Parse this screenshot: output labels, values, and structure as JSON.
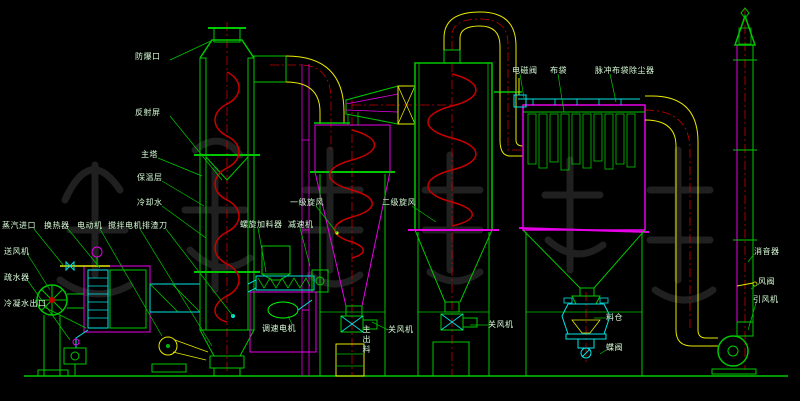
{
  "colors": {
    "background": "#000000",
    "green": "#00c800",
    "bright": "#00ff00",
    "cyan": "#00e5e5",
    "magenta": "#e800e8",
    "red": "#c80000",
    "yellow": "#e8e800",
    "label": "#d8f0d8",
    "watermark": "#202020"
  },
  "diagram": {
    "type": "process-flow-diagram",
    "subject": "spin-flash-drying-system"
  },
  "labels": [
    {
      "id": "explosion-vent",
      "text": "防爆口",
      "x": 135,
      "y": 52,
      "leader": [
        170,
        60,
        213,
        40
      ]
    },
    {
      "id": "reflection-screen",
      "text": "反射屏",
      "x": 135,
      "y": 108,
      "leader": [
        170,
        116,
        222,
        180
      ]
    },
    {
      "id": "main-tower",
      "text": "主塔",
      "x": 141,
      "y": 150,
      "leader": [
        158,
        158,
        202,
        176
      ]
    },
    {
      "id": "insulation-layer",
      "text": "保温层",
      "x": 137,
      "y": 173,
      "leader": [
        162,
        181,
        204,
        206
      ]
    },
    {
      "id": "cooling-water",
      "text": "冷却水",
      "x": 137,
      "y": 198,
      "leader": [
        162,
        206,
        206,
        238
      ]
    },
    {
      "id": "steam-inlet",
      "text": "蒸汽进口",
      "x": 2,
      "y": 221,
      "leader": [
        34,
        229,
        64,
        266
      ]
    },
    {
      "id": "heat-exchanger",
      "text": "换热器",
      "x": 44,
      "y": 221,
      "leader": [
        68,
        229,
        100,
        268
      ]
    },
    {
      "id": "electric-motor",
      "text": "电动机",
      "x": 77,
      "y": 221,
      "leader": [
        100,
        229,
        162,
        336
      ]
    },
    {
      "id": "agitator-motor",
      "text": "搅拌电机",
      "x": 108,
      "y": 221,
      "leader": [
        140,
        229,
        212,
        346
      ]
    },
    {
      "id": "scraper-knife",
      "text": "排渣刀",
      "x": 142,
      "y": 221,
      "leader": [
        166,
        229,
        233,
        316
      ]
    },
    {
      "id": "supply-fan",
      "text": "送风机",
      "x": 4,
      "y": 247,
      "leader": [
        28,
        255,
        50,
        290
      ]
    },
    {
      "id": "steam-trap",
      "text": "疏水器",
      "x": 4,
      "y": 273,
      "leader": [
        28,
        281,
        70,
        340
      ]
    },
    {
      "id": "condensate-outlet",
      "text": "冷凝水出口",
      "x": 4,
      "y": 299,
      "leader": [
        44,
        307,
        86,
        328
      ]
    },
    {
      "id": "screw-feeder",
      "text": "螺旋加料器",
      "x": 240,
      "y": 220,
      "leader": [
        258,
        228,
        266,
        272
      ]
    },
    {
      "id": "reducer",
      "text": "减速机",
      "x": 288,
      "y": 220,
      "leader": [
        300,
        228,
        310,
        266
      ]
    },
    {
      "id": "primary-cyclone",
      "text": "一级旋风",
      "x": 290,
      "y": 198,
      "leader": [
        316,
        206,
        337,
        233
      ]
    },
    {
      "id": "secondary-cyclone",
      "text": "二级旋风",
      "x": 382,
      "y": 198,
      "leader": [
        412,
        206,
        436,
        222
      ]
    },
    {
      "id": "solenoid-valve",
      "text": "电磁阀",
      "x": 512,
      "y": 66,
      "leader": [
        520,
        74,
        524,
        98
      ]
    },
    {
      "id": "filter-bag",
      "text": "布袋",
      "x": 550,
      "y": 66,
      "leader": [
        558,
        74,
        564,
        112
      ]
    },
    {
      "id": "pulse-bag-dust-collector",
      "text": "脉冲布袋除尘器",
      "x": 595,
      "y": 66,
      "leader": [
        610,
        74,
        616,
        102
      ]
    },
    {
      "id": "variable-speed-motor",
      "text": "调速电机",
      "x": 262,
      "y": 324,
      "leader": [
        292,
        324,
        288,
        316
      ]
    },
    {
      "id": "main-discharge",
      "text": "主出料",
      "x": 362,
      "y": 325,
      "vertical": true
    },
    {
      "id": "rotary-airlock-1",
      "text": "关风机",
      "x": 388,
      "y": 325,
      "leader": [
        388,
        330,
        372,
        322
      ]
    },
    {
      "id": "rotary-airlock-2",
      "text": "关风机",
      "x": 488,
      "y": 320,
      "leader": [
        488,
        325,
        470,
        325
      ]
    },
    {
      "id": "material-hopper",
      "text": "料仓",
      "x": 606,
      "y": 313,
      "leader": [
        606,
        318,
        594,
        318
      ]
    },
    {
      "id": "butterfly-valve",
      "text": "蝶阀",
      "x": 606,
      "y": 343,
      "leader": [
        606,
        350,
        600,
        354
      ]
    },
    {
      "id": "silencer",
      "text": "消音器",
      "x": 754,
      "y": 247,
      "leader": [
        754,
        254,
        748,
        262
      ]
    },
    {
      "id": "air-valve",
      "text": "风阀",
      "x": 758,
      "y": 277,
      "leader": [
        758,
        284,
        751,
        289
      ]
    },
    {
      "id": "induced-draft-fan",
      "text": "引风机",
      "x": 753,
      "y": 295,
      "leader": [
        756,
        303,
        748,
        330
      ]
    }
  ]
}
